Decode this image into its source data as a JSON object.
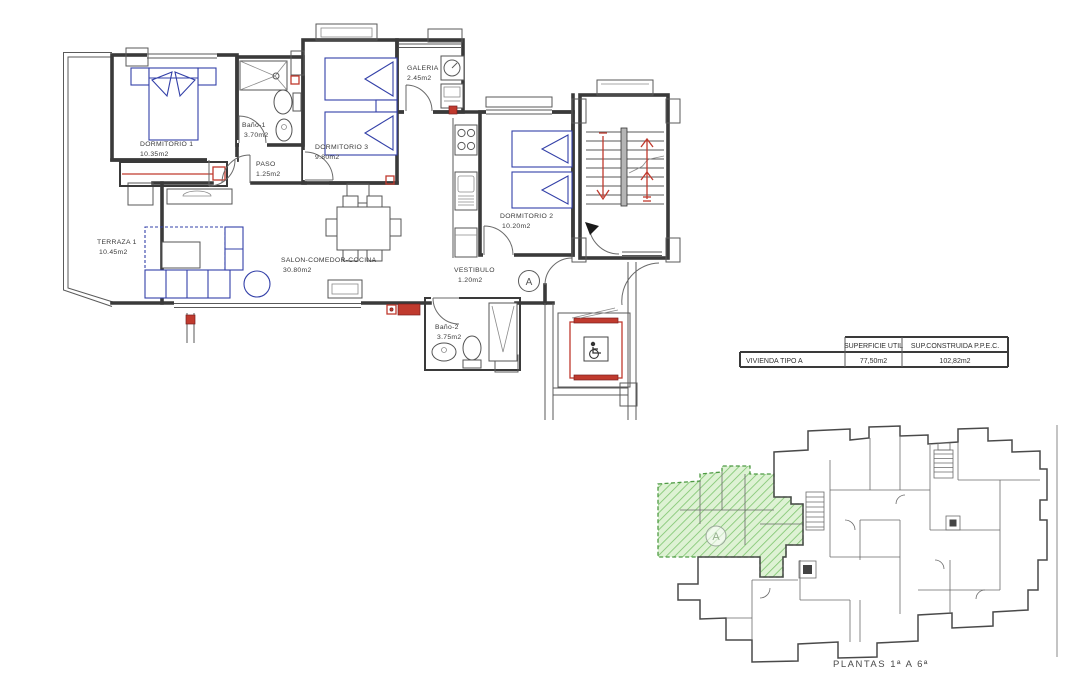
{
  "drawing": {
    "unit_marker": "A",
    "rooms": [
      {
        "id": "dormitorio-1",
        "name": "DORMITORIO 1",
        "area": "10.35m2"
      },
      {
        "id": "bano-1",
        "name": "Baño-1",
        "area": "3.70m2"
      },
      {
        "id": "dormitorio-3",
        "name": "DORMITORIO 3",
        "area": "9.80m2"
      },
      {
        "id": "galeria",
        "name": "GALERIA",
        "area": "2.45m2"
      },
      {
        "id": "paso",
        "name": "PASO",
        "area": "1.25m2"
      },
      {
        "id": "terraza-1",
        "name": "TERRAZA 1",
        "area": "10.45m2"
      },
      {
        "id": "salon",
        "name": "SALON-COMEDOR-COCINA",
        "area": "30.80m2"
      },
      {
        "id": "dormitorio-2",
        "name": "DORMITORIO 2",
        "area": "10.20m2"
      },
      {
        "id": "vestibulo",
        "name": "VESTIBULO",
        "area": "1.20m2"
      },
      {
        "id": "bano-2",
        "name": "Baño-2",
        "area": "3.75m2"
      }
    ]
  },
  "areas_table": {
    "headers": [
      "",
      "SUPERFICIE UTIL",
      "SUP.CONSTRUIDA  P.P.E.C."
    ],
    "rows": [
      {
        "label": "VIVIENDA TIPO A",
        "superficie_util": "77,50m2",
        "sup_construida": "102,82m2"
      }
    ]
  },
  "keyplan": {
    "caption": "PLANTAS  1ª  A  6ª",
    "unit_marker": "A"
  },
  "colors": {
    "walls": "#3a3a3a",
    "furniture_blue": "#3340a8",
    "accent_red": "#c03a2e",
    "highlight_green": "#7cc46c",
    "pier_blue": "#4a4aa8"
  }
}
